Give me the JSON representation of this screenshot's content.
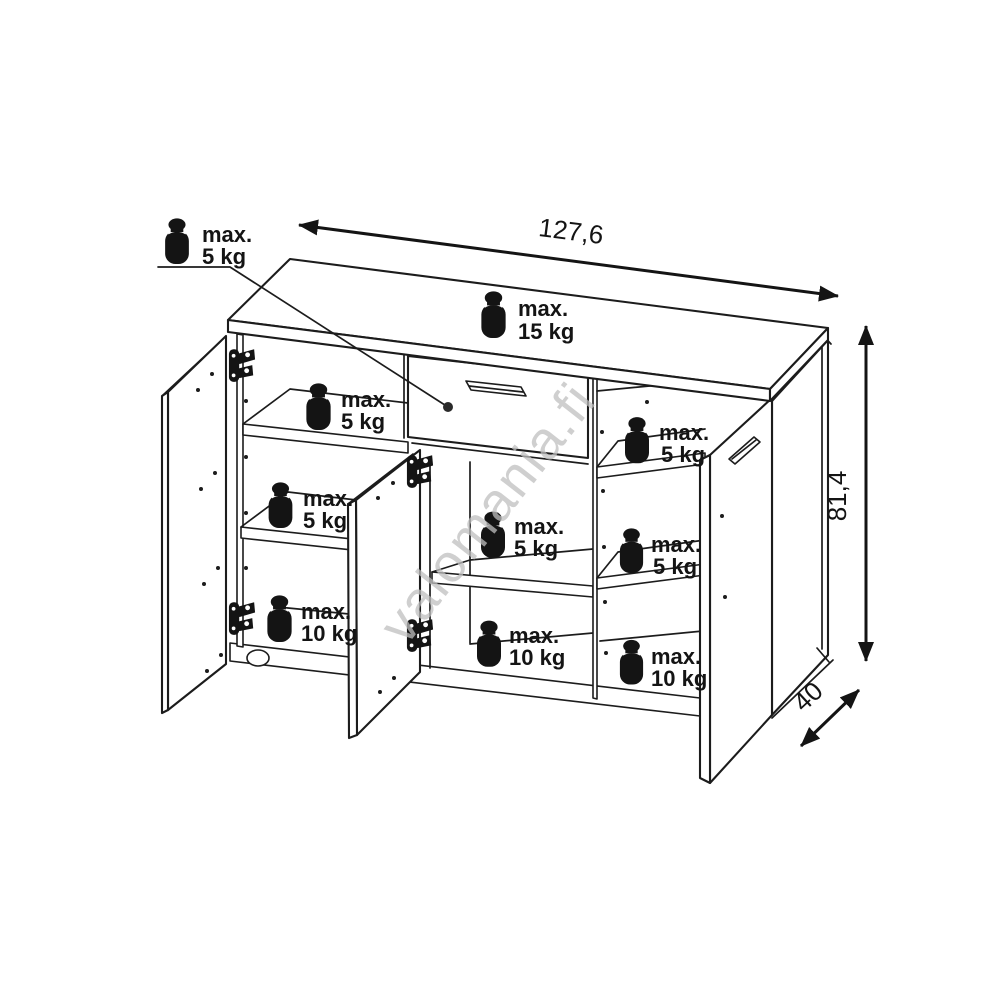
{
  "watermark": "valomania.fi",
  "dimensions": {
    "width": "127,6",
    "height": "81,4",
    "depth": "40"
  },
  "weight_labels": {
    "drawer": {
      "line1": "max.",
      "line2": "5 kg"
    },
    "top_surface": {
      "line1": "max.",
      "line2": "15 kg"
    },
    "left_top_shelf": {
      "line1": "max.",
      "line2": "5 kg"
    },
    "left_middle_shelf": {
      "line1": "max.",
      "line2": "5 kg"
    },
    "left_bottom": {
      "line1": "max.",
      "line2": "10 kg"
    },
    "middle_shelf": {
      "line1": "max.",
      "line2": "5 kg"
    },
    "middle_bottom": {
      "line1": "max.",
      "line2": "10 kg"
    },
    "right_top_shelf": {
      "line1": "max.",
      "line2": "5 kg"
    },
    "right_middle_shelf": {
      "line1": "max.",
      "line2": "5 kg"
    },
    "right_bottom": {
      "line1": "max.",
      "line2": "10 kg"
    }
  }
}
